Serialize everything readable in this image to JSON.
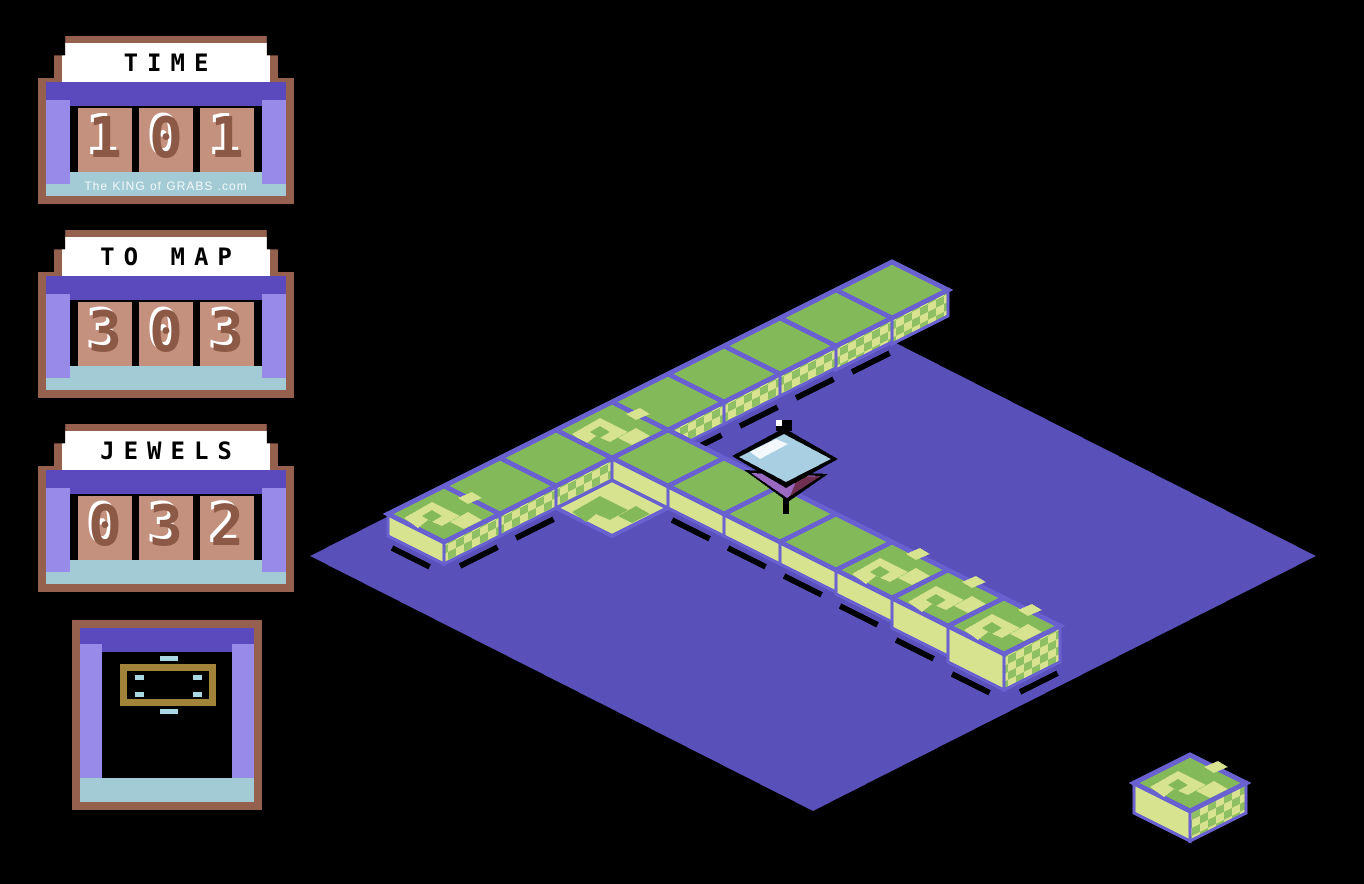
{
  "game": {
    "title": "isometric arcade playfield",
    "player": "gyroscope-top"
  },
  "hud": {
    "counters": [
      {
        "id": "time",
        "label": "TIME",
        "value": "101",
        "digits": [
          "1",
          "0",
          "1"
        ],
        "watermark": "The KING of GRABS .com"
      },
      {
        "id": "to-map",
        "label": "TO MAP",
        "value": "303",
        "digits": [
          "3",
          "0",
          "3"
        ]
      },
      {
        "id": "jewels",
        "label": "JEWELS",
        "value": "032",
        "digits": [
          "0",
          "3",
          "2"
        ]
      }
    ],
    "minimap": {
      "frame": "map-outline-rectangle",
      "marks": [
        "dash-top",
        "corner-tl",
        "corner-tr",
        "corner-bl",
        "corner-br",
        "dash-bottom"
      ]
    }
  },
  "scene": {
    "colors": {
      "bg": "#000000",
      "floor": "#5a50ba",
      "grid": "#6a61d0",
      "tile_top": "#84b95a",
      "tile_pale": "#d8e38f",
      "checker_a": "#d8e38f",
      "checker_b": "#8fbf63",
      "shadow": "#000000",
      "player_top": "#a9cfe2",
      "player_glint": "#ffffff",
      "player_cone": "#9a6ac2",
      "player_cone_shade": "#6e2f50",
      "player_outline": "#000000"
    },
    "iso": {
      "half_w": 56,
      "half_h": 28,
      "depth": 22,
      "origin_x": 612,
      "origin_y": 430
    },
    "floor_points": [
      [
        310,
        556
      ],
      [
        813,
        301
      ],
      [
        1316,
        556
      ],
      [
        813,
        811
      ]
    ],
    "tiles": [
      {
        "c": 0,
        "r": -5,
        "t": "plain",
        "d": 26
      },
      {
        "c": 0,
        "r": -4,
        "t": "plain",
        "d": 24
      },
      {
        "c": 0,
        "r": -3,
        "t": "plain",
        "d": 22
      },
      {
        "c": 0,
        "r": -2,
        "t": "plain",
        "d": 22
      },
      {
        "c": 0,
        "r": -1,
        "t": "plain",
        "d": 22
      },
      {
        "c": 0,
        "r": 0,
        "t": "mottled",
        "d": 22
      },
      {
        "c": 0,
        "r": 1,
        "t": "plain",
        "d": 22
      },
      {
        "c": 0,
        "r": 2,
        "t": "plain",
        "d": 22
      },
      {
        "c": 0,
        "r": 3,
        "t": "mottled",
        "d": 22
      },
      {
        "c": 1,
        "r": 0,
        "t": "plain",
        "d": 22
      },
      {
        "c": 2,
        "r": 0,
        "t": "plain",
        "d": 22
      },
      {
        "c": 3,
        "r": 0,
        "t": "plain",
        "d": 22
      },
      {
        "c": 4,
        "r": 0,
        "t": "plain",
        "d": 22
      },
      {
        "c": 5,
        "r": 0,
        "t": "mottled",
        "d": 24
      },
      {
        "c": 6,
        "r": 0,
        "t": "mottled",
        "d": 30
      },
      {
        "c": 7,
        "r": 0,
        "t": "mottled",
        "d": 36
      }
    ],
    "floor_decals": [
      {
        "c": 1,
        "r": 1
      }
    ],
    "player": {
      "c": 3,
      "r": 0,
      "x_nudge": 6
    },
    "isolated_tile": {
      "x": 1190,
      "y": 783,
      "d": 30,
      "t": "mottled"
    }
  }
}
